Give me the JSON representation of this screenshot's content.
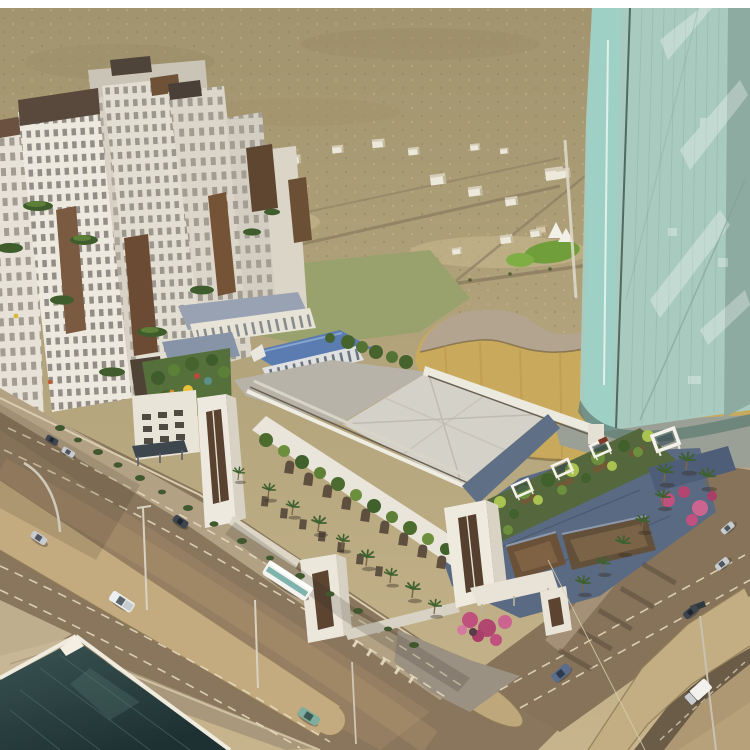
{
  "scene": {
    "type": "architectural aerial rendering",
    "description": "Aerial rendering of a desert-city mixed-use development: a cluster of white residential towers with brown stone accents and planted terraces, a convention complex with a large light-gray hall roof, blue pitched clerestory hall, arched arcade facade and rooftop gardens with white pergolas, a curvy gold podium carrying a tall teal glass skyscraper, wide boulevards with a sand median, palm trees, cars, a white bus and an underpass ramp in the foreground, with a dark glass roof building at the lower left.",
    "setting": "desert cityscape",
    "time_of_day": "daytime"
  },
  "palette": {
    "border_white": "#ffffff",
    "desert": "#ab9c76",
    "desert_light": "#c7b48c",
    "field_olive": "#99a26d",
    "lawn_green": "#6f9e3a",
    "glass_face": "#a9cabf",
    "glass_light": "#9fd0c5",
    "glass_edge": "#8ba79e",
    "podium_gold": "#c9a95c",
    "podium_top": "#b2a48f",
    "surround_gray": "#9aa095",
    "tower_white": "#eee9df",
    "accent_brown": "#6b4b33",
    "roof_gray": "#d4d1c9",
    "roof_blue": "#5a7cb0",
    "block_blue": "#5a6a82",
    "courtyard_brown": "#6b5138",
    "wall_white": "#e9e5da",
    "road_brown": "#8a765c",
    "median_sand": "#c4ab7f",
    "sidewalk_tan": "#b3a184",
    "trench_wall": "#c3ad82",
    "foliage_dark": "#40602c",
    "foliage_bright": "#a9c250",
    "bougainvillea_pink": "#c0507e",
    "foreground_glass": "#2c4543",
    "vehicle_white": "#f4f3ef"
  },
  "objects": {
    "towers_label": "white residential towers with planted terraces",
    "glass_tower_label": "teal glass skyscraper",
    "podium_label": "curved gold podium",
    "hall_label": "convention hall with gray roof",
    "blue_hall_label": "blue pitched clerestory hall",
    "arcade_label": "arched arcade facade",
    "garden_label": "rooftop gardens with white pergolas",
    "boulevard_label": "main boulevard with sand median",
    "underpass_label": "underpass ramp",
    "foreground_label": "dark glass roof building",
    "vehicles": [
      "white bus",
      "white pickup",
      "white box truck",
      "silver sedans",
      "dark sedans",
      "teal sedan",
      "blue sedan"
    ],
    "vegetation": [
      "palm trees",
      "street shrubs",
      "bougainvillea",
      "lawn",
      "terrace planting",
      "garden umbrellas"
    ]
  }
}
